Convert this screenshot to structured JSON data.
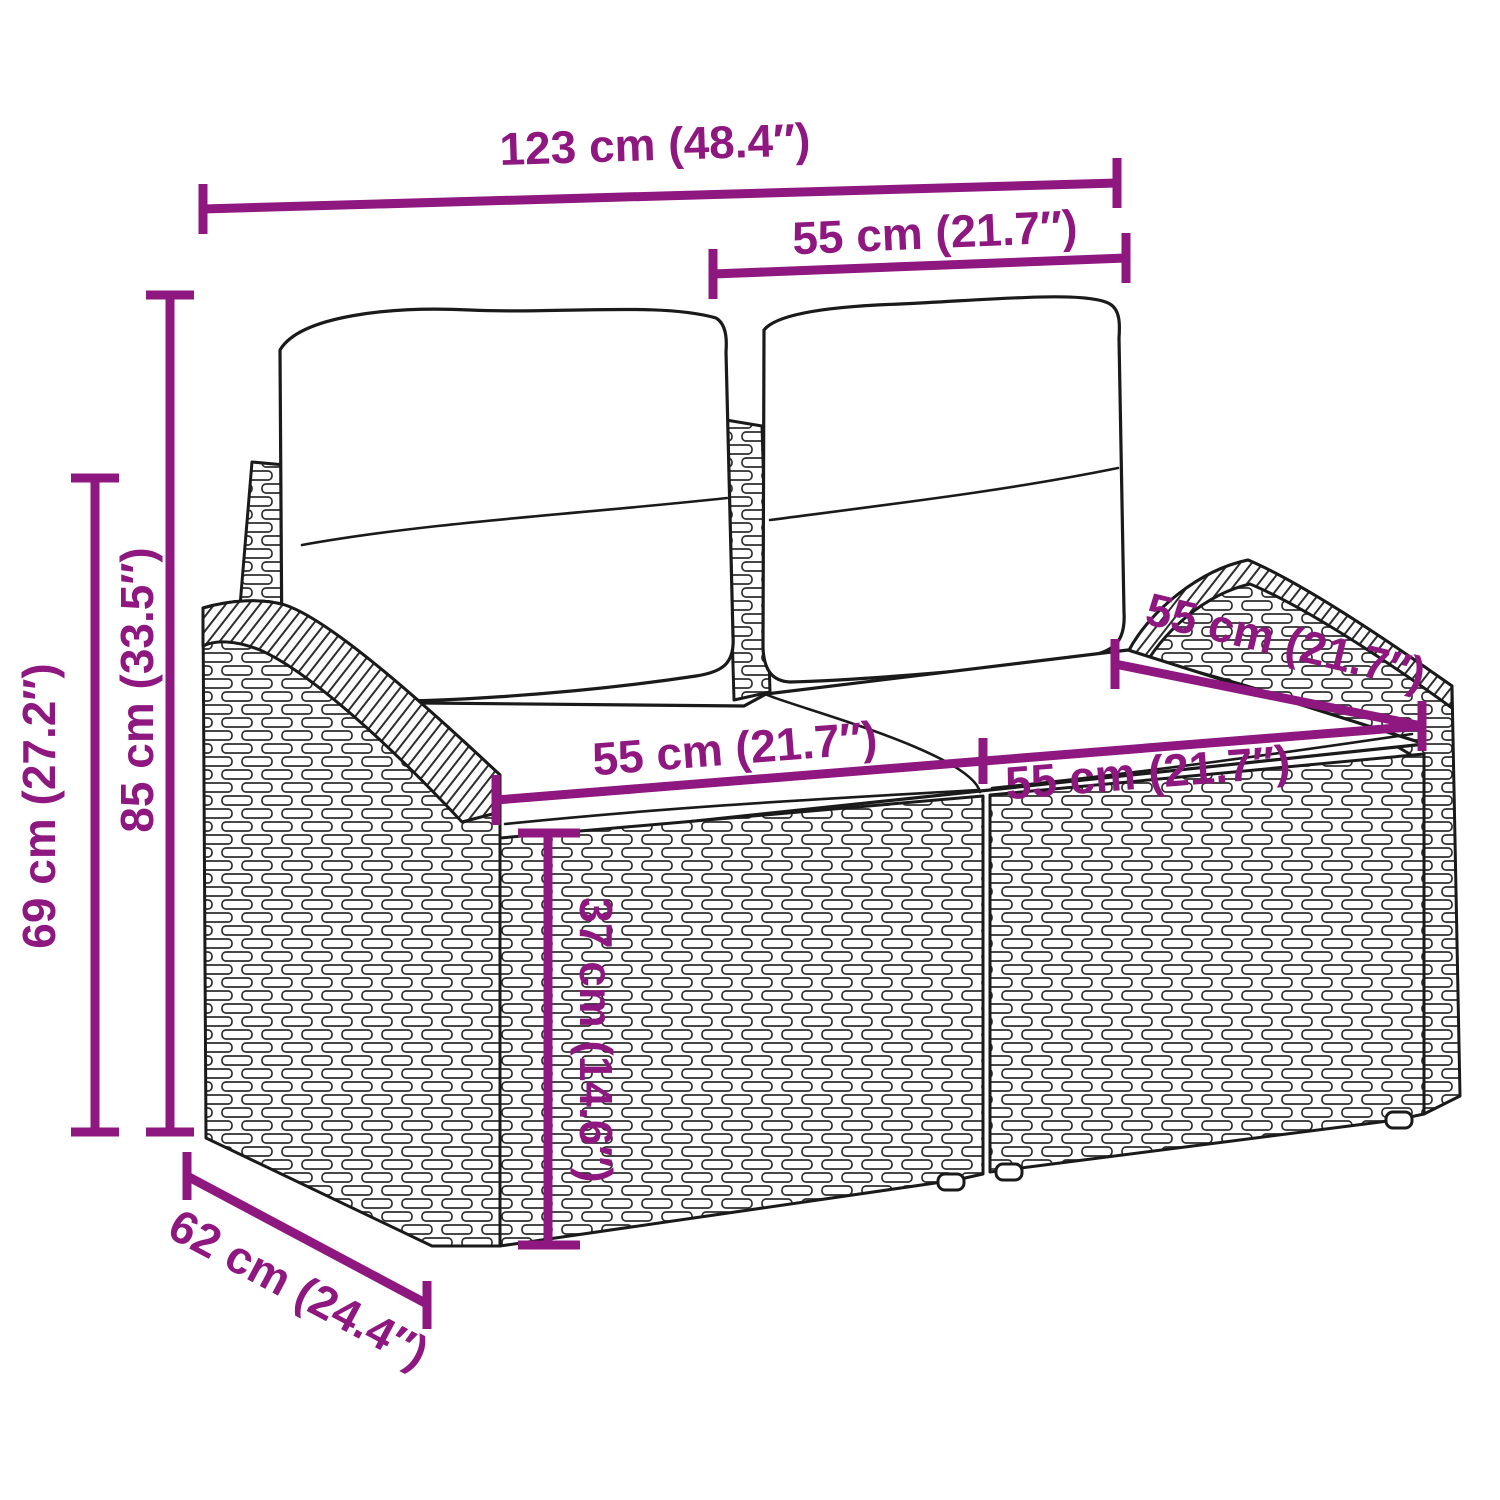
{
  "figure": {
    "kind": "product dimension diagram",
    "subject": "poly rattan 2-seater garden sofa with back and seat cushions"
  },
  "colors": {
    "dimension_accent": "#8E1780",
    "line_art": "#1a1a1a",
    "background": "#ffffff"
  },
  "labels": {
    "overall_width": "123 cm (48.4″)",
    "backrest_width": "55 cm (21.7″)",
    "height_total": "85 cm (33.5″)",
    "height_armrest": "69 cm (27.2″)",
    "seat_width_left": "55 cm (21.7″)",
    "seat_width_right": "55 cm (21.7″)",
    "seat_depth": "55 cm (21.7″)",
    "seat_height": "37 cm (14.6″)",
    "depth_total": "62 cm (24.4″)"
  }
}
